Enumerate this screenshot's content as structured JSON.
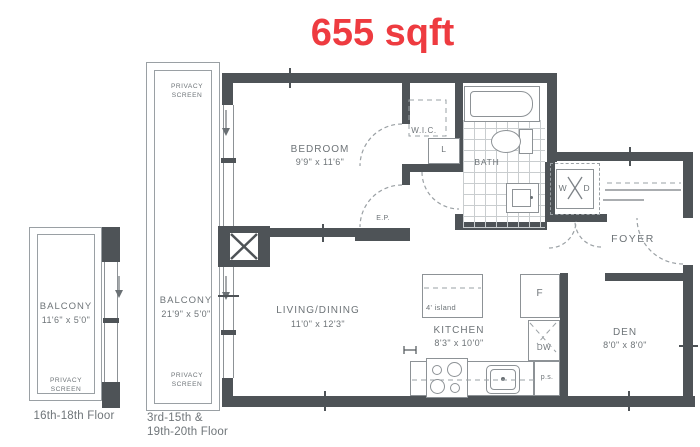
{
  "title": {
    "text": "655 sqft"
  },
  "colors": {
    "accent_red": "#ee3b40",
    "wall": "#4e5357",
    "line": "#9aa0a4",
    "text": "#6e7478",
    "background": "#ffffff"
  },
  "floor_labels": {
    "left": "16th-18th Floor",
    "right_line1": "3rd-15th &",
    "right_line2": "19th-20th Floor"
  },
  "balcony_left": {
    "name": "BALCONY",
    "dims": "11'6\" x 5'0\"",
    "privacy": "PRIVACY SCREEN"
  },
  "balcony_main": {
    "name": "BALCONY",
    "dims": "21'9\" x 5'0\"",
    "privacy_top": "PRIVACY SCREEN",
    "privacy_bottom": "PRIVACY SCREEN"
  },
  "rooms": {
    "bedroom": {
      "name": "BEDROOM",
      "dims": "9'9\" x 11'6\""
    },
    "living": {
      "name": "LIVING/DINING",
      "dims": "11'0\" x 12'3\""
    },
    "kitchen": {
      "name": "KITCHEN",
      "dims": "8'3\" x 10'0\""
    },
    "den": {
      "name": "DEN",
      "dims": "8'0\" x 8'0\""
    },
    "bath": {
      "name": "BATH"
    },
    "wic": {
      "name": "W.I.C."
    },
    "foyer": {
      "name": "FOYER"
    }
  },
  "fixtures": {
    "island": "4' island",
    "linen": "L",
    "fridge": "F",
    "dishwasher": "DW",
    "pipe_shaft": "p.s.",
    "electrical_panel": "E.P.",
    "washer": "W",
    "dryer": "D"
  }
}
